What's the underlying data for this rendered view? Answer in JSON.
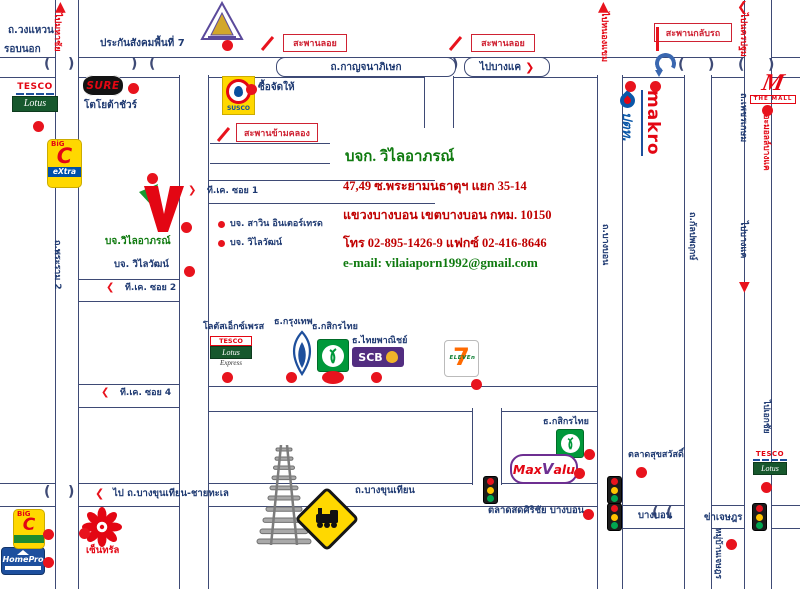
{
  "company": {
    "name": "บจก. วิไลอาภรณ์",
    "address_line1": "47,49 ซ.พระยามนธาตุฯ แยก 35-14",
    "address_line2": "แขวงบางบอน เขตบางบอน กทม. 10150",
    "phone_line": "โทร 02-895-1426-9 แฟกซ์ 02-416-8646",
    "email_line": "e-mail: vilaiaporn1992@gmail.com"
  },
  "colors": {
    "accent_red": "#e30613",
    "navy_text": "#1f3a72",
    "green_text": "#0f7a0f",
    "road_line": "#3e4a75"
  },
  "logos": {
    "tesco": "TESCO",
    "lotus": "Lotus",
    "express": "Express",
    "sure": "SURE",
    "bigc": "BiG",
    "bigc_c": "C",
    "bigc_extra": "eXtra",
    "susco": "SUSCO",
    "scb": "SCB",
    "seven": "7",
    "eleven": "ELEVEn",
    "maxvalu_pre": "Max",
    "maxvalu_v": "V",
    "maxvalu_post": "alu",
    "makro": "makro",
    "ptt": "ปตท.",
    "themall_m": "M",
    "themall": "THE MALL",
    "homepro": "HomePro"
  },
  "roads": [
    {
      "id": "kanchanaphisek-road",
      "o": "h",
      "x": 0,
      "y": 57,
      "w": 800,
      "h": 19
    },
    {
      "id": "tk-soi1-road",
      "o": "h",
      "x": 207,
      "y": 180,
      "w": 228,
      "h": 22
    },
    {
      "id": "tk-soi2-road",
      "o": "h",
      "x": 77,
      "y": 279,
      "w": 102,
      "h": 21
    },
    {
      "id": "tk-soi4-road",
      "o": "h",
      "x": 77,
      "y": 384,
      "w": 102,
      "h": 22
    },
    {
      "id": "mid-shops-road",
      "o": "h",
      "x": 207,
      "y": 386,
      "w": 390,
      "h": 24
    },
    {
      "id": "bangkhunthian-road",
      "o": "h",
      "x": 0,
      "y": 483,
      "w": 622,
      "h": 22
    },
    {
      "id": "ekkachai-east-road",
      "o": "h",
      "x": 622,
      "y": 505,
      "w": 178,
      "h": 22
    },
    {
      "id": "canal-road-horiz",
      "o": "h",
      "x": 210,
      "y": 143,
      "w": 120,
      "h": 19
    },
    {
      "id": "outer-ring-west-road",
      "o": "v",
      "x": 55,
      "y": 0,
      "w": 22,
      "h": 589
    },
    {
      "id": "tk-main-road",
      "o": "v",
      "x": 179,
      "y": 75,
      "w": 28,
      "h": 514
    },
    {
      "id": "canal-road-vert",
      "o": "v",
      "x": 424,
      "y": 76,
      "w": 28,
      "h": 52
    },
    {
      "id": "phraya-monthat-soi",
      "o": "v",
      "x": 472,
      "y": 408,
      "w": 28,
      "h": 77
    },
    {
      "id": "bangbon-vert-road",
      "o": "v",
      "x": 597,
      "y": 75,
      "w": 24,
      "h": 514
    },
    {
      "id": "kanlapaphruek-vert-road",
      "o": "v",
      "x": 684,
      "y": 75,
      "w": 26,
      "h": 514
    },
    {
      "id": "phetkasem-vert-road",
      "o": "v",
      "x": 744,
      "y": 0,
      "w": 26,
      "h": 589
    }
  ],
  "labels": [
    {
      "id": "ring-road-name-line1",
      "text": "ถ.วงแหวน",
      "x": 8,
      "y": 25
    },
    {
      "id": "ring-road-name-line2",
      "text": "รอบนอก",
      "x": 4,
      "y": 44
    },
    {
      "id": "to-mahachai",
      "text": "ไปมหาชัย",
      "x": 62,
      "y": 13,
      "rot": 1,
      "color": "red",
      "size": 9
    },
    {
      "id": "sso-office",
      "text": "ประกันสังคมพื้นที่ 7",
      "x": 100,
      "y": 38,
      "size": 10
    },
    {
      "id": "shop-sue-jad-hai",
      "text": "ซื้อจัดให้",
      "x": 258,
      "y": 82
    },
    {
      "id": "toyota-sure",
      "text": "โตโยต้าชัวร์",
      "x": 84,
      "y": 100
    },
    {
      "id": "tk-soi-1",
      "text": "ที.เค. ซอย 1",
      "x": 207,
      "y": 186,
      "size": 9
    },
    {
      "id": "co-savin-intertrade",
      "text": "บจ. สาวิน อินเตอร์เทรด",
      "x": 230,
      "y": 219,
      "size": 9
    },
    {
      "id": "co-vilaiwat-1",
      "text": "บจ. วิไลวัฒน์",
      "x": 230,
      "y": 238,
      "size": 9
    },
    {
      "id": "co-vilaiaporn",
      "text": "บจ.วิไลอาภรณ์",
      "x": 105,
      "y": 236,
      "color": "green",
      "size": 10
    },
    {
      "id": "co-vilaiwat-2",
      "text": "บจ. วิไลวัฒน์",
      "x": 114,
      "y": 260,
      "size": 9.5
    },
    {
      "id": "tk-soi-2",
      "text": "ที.เค. ซอย 2",
      "x": 125,
      "y": 283,
      "size": 9
    },
    {
      "id": "tk-soi-4",
      "text": "ที.เค. ซอย 4",
      "x": 120,
      "y": 388,
      "size": 9
    },
    {
      "id": "rama2-road",
      "text": "ถ.พระราม 2",
      "x": 62,
      "y": 240,
      "rot": 1,
      "size": 9
    },
    {
      "id": "lotus-express-label",
      "text": "โลตัสเอ็กซ์เพรส",
      "x": 203,
      "y": 322,
      "size": 9
    },
    {
      "id": "bank-bangkok",
      "text": "ธ.กรุงเทพ",
      "x": 274,
      "y": 317,
      "size": 9
    },
    {
      "id": "bank-kasikorn-1",
      "text": "ธ.กสิกรไทย",
      "x": 312,
      "y": 322,
      "size": 9
    },
    {
      "id": "bank-scb",
      "text": "ธ.ไทยพาณิชย์",
      "x": 352,
      "y": 336,
      "size": 9
    },
    {
      "id": "bank-kasikorn-2",
      "text": "ธ.กสิกรไทย",
      "x": 543,
      "y": 417,
      "size": 9
    },
    {
      "id": "market-suksawat",
      "text": "ตลาดสุขสวัสดิ์",
      "x": 628,
      "y": 450,
      "size": 9
    },
    {
      "id": "market-sirichai",
      "text": "ตลาดสดศิริชัย บางบอน",
      "x": 488,
      "y": 506,
      "size": 9.5
    },
    {
      "id": "road-seg-bangbon",
      "text": "บางบอน",
      "x": 638,
      "y": 511,
      "size": 9.5
    },
    {
      "id": "road-seg-chetsada",
      "text": "ข่าเจษฎร",
      "x": 704,
      "y": 513,
      "size": 9.5
    },
    {
      "id": "mooban-chetsada",
      "text": "หมู่บ้านเจษฎร",
      "x": 722,
      "y": 528,
      "rot": 1,
      "size": 8.5
    },
    {
      "id": "to-ekkachai",
      "text": "ไปเอกชัย",
      "x": 770,
      "y": 400,
      "rot": 1,
      "size": 8.5
    },
    {
      "id": "to-bangkhunthian-chaithale",
      "text": "ไป ถ.บางขุนเทียน-ชายทะเล",
      "x": 113,
      "y": 489,
      "size": 9.5
    },
    {
      "id": "bangkhunthian-label",
      "text": "ถ.บางขุนเทียน",
      "x": 355,
      "y": 486,
      "size": 9.5
    },
    {
      "id": "central-label",
      "text": "เซ็นทรัล",
      "x": 86,
      "y": 546,
      "color": "red",
      "size": 9.5
    },
    {
      "id": "to-nongkhaem",
      "text": "ไปหนองแขม",
      "x": 609,
      "y": 12,
      "rot": 1,
      "color": "red",
      "size": 9
    },
    {
      "id": "to-nakhonpathom",
      "text": "ไปนครปฐม",
      "x": 748,
      "y": 13,
      "rot": 1,
      "color": "red",
      "size": 9
    },
    {
      "id": "phetkasem-road",
      "text": "ถ.เพชรเกษม",
      "x": 748,
      "y": 93,
      "rot": 1,
      "size": 9
    },
    {
      "id": "the-mall-bangkhae",
      "text": "เดอะมอลล์บางแค",
      "x": 770,
      "y": 106,
      "rot": 1,
      "color": "red",
      "size": 8.5
    },
    {
      "id": "kanlapaphruek-road",
      "text": "ถ.กัลปพฤกษ์",
      "x": 697,
      "y": 212,
      "rot": 1,
      "size": 9
    },
    {
      "id": "to-bangkhae-south",
      "text": "ไปบางแค",
      "x": 748,
      "y": 221,
      "rot": 1,
      "size": 9
    },
    {
      "id": "bangbon-road",
      "text": "ถ.บางบอน",
      "x": 610,
      "y": 224,
      "rot": 1,
      "size": 9
    }
  ],
  "boxes": [
    {
      "id": "kanchanaphisek-box",
      "text": "ถ.กาญจนาภิเษก",
      "x": 276,
      "y": 57,
      "w": 178,
      "h": 18,
      "style": "road"
    },
    {
      "id": "to-bangkhae-box",
      "text": "ไปบางแค",
      "x": 464,
      "y": 57,
      "w": 84,
      "h": 18,
      "style": "road",
      "arrow": "❯"
    },
    {
      "id": "flyover-box-1",
      "text": "สะพานลอย",
      "x": 283,
      "y": 34,
      "w": 62,
      "h": 16,
      "style": "red"
    },
    {
      "id": "flyover-box-2",
      "text": "สะพานลอย",
      "x": 471,
      "y": 34,
      "w": 62,
      "h": 16,
      "style": "red"
    },
    {
      "id": "uturn-bridge-box",
      "text": "สะพานกลับรถ",
      "x": 654,
      "y": 23,
      "w": 76,
      "h": 17,
      "style": "red"
    },
    {
      "id": "canal-bridge-box",
      "text": "สะพานข้ามคลอง",
      "x": 236,
      "y": 123,
      "w": 80,
      "h": 17,
      "style": "red"
    }
  ],
  "dots": [
    {
      "id": "poi-sso",
      "x": 222,
      "y": 40
    },
    {
      "id": "poi-sure",
      "x": 128,
      "y": 83
    },
    {
      "id": "poi-lotus-west",
      "x": 33,
      "y": 121
    },
    {
      "id": "poi-vlogo-top",
      "x": 147,
      "y": 173
    },
    {
      "id": "poi-susco-shop",
      "x": 246,
      "y": 84
    },
    {
      "id": "poi-vilaiaporn",
      "x": 181,
      "y": 222
    },
    {
      "id": "poi-vilaiwat",
      "x": 184,
      "y": 266
    },
    {
      "id": "bullet-savin",
      "x": 218,
      "y": 221,
      "w": 7,
      "h": 7
    },
    {
      "id": "bullet-vilaiwat",
      "x": 218,
      "y": 240,
      "w": 7,
      "h": 7
    },
    {
      "id": "poi-lotus-express",
      "x": 222,
      "y": 372
    },
    {
      "id": "poi-bbl",
      "x": 286,
      "y": 372
    },
    {
      "id": "poi-kbank",
      "x": 322,
      "y": 371,
      "w": 22,
      "h": 13
    },
    {
      "id": "poi-scb",
      "x": 371,
      "y": 372
    },
    {
      "id": "poi-seven",
      "x": 471,
      "y": 379
    },
    {
      "id": "poi-kbank-2",
      "x": 584,
      "y": 449
    },
    {
      "id": "poi-suksawat",
      "x": 636,
      "y": 467
    },
    {
      "id": "poi-maxvalu",
      "x": 574,
      "y": 468
    },
    {
      "id": "poi-sirichai",
      "x": 583,
      "y": 509
    },
    {
      "id": "poi-lotus-bangbon",
      "x": 761,
      "y": 482
    },
    {
      "id": "poi-mooban",
      "x": 726,
      "y": 539
    },
    {
      "id": "poi-themall",
      "x": 762,
      "y": 105
    },
    {
      "id": "poi-makro-1",
      "x": 625,
      "y": 81
    },
    {
      "id": "poi-makro-2",
      "x": 650,
      "y": 81
    },
    {
      "id": "poi-central",
      "x": 79,
      "y": 528
    },
    {
      "id": "poi-bigc-south",
      "x": 43,
      "y": 529
    },
    {
      "id": "poi-homepro",
      "x": 43,
      "y": 557
    }
  ],
  "arrows": [
    {
      "id": "arrow-up-mahachai",
      "char": "▲",
      "x": 55,
      "y": 0,
      "size": 14
    },
    {
      "id": "arrow-up-nongkhaem",
      "char": "▲",
      "x": 598,
      "y": 0,
      "size": 14
    },
    {
      "id": "arrow-left-nakhonpathom",
      "char": "❮",
      "x": 737,
      "y": 1,
      "size": 13
    },
    {
      "id": "arrow-down-bangkhae",
      "char": "▼",
      "x": 739,
      "y": 280,
      "size": 14
    },
    {
      "id": "arrow-soi1",
      "char": "❯",
      "x": 188,
      "y": 186,
      "size": 10
    },
    {
      "id": "arrow-soi2",
      "char": "❮",
      "x": 106,
      "y": 283,
      "size": 10
    },
    {
      "id": "arrow-soi4",
      "char": "❮",
      "x": 101,
      "y": 388,
      "size": 10
    },
    {
      "id": "arrow-bangkhunthian",
      "char": "❮",
      "x": 95,
      "y": 488,
      "size": 11
    }
  ],
  "marks": [
    {
      "id": "flyover-slash-1",
      "x": 266,
      "y": 35,
      "w": 3,
      "h": 17,
      "rot": 40
    },
    {
      "id": "flyover-slash-2",
      "x": 454,
      "y": 35,
      "w": 3,
      "h": 17,
      "rot": 40
    },
    {
      "id": "canal-slash",
      "x": 222,
      "y": 126,
      "w": 3,
      "h": 17,
      "rot": 40
    },
    {
      "id": "uturn-pointer",
      "x": 656,
      "y": 27,
      "w": 2.5,
      "h": 24,
      "rot": 0
    }
  ],
  "arcs": [
    {
      "ch": "(",
      "x": 44,
      "y": 57
    },
    {
      "ch": ")",
      "x": 68,
      "y": 57
    },
    {
      "ch": ")",
      "x": 131,
      "y": 57
    },
    {
      "ch": "(",
      "x": 149,
      "y": 57
    },
    {
      "ch": "(",
      "x": 44,
      "y": 485
    },
    {
      "ch": ")",
      "x": 68,
      "y": 485
    },
    {
      "ch": "(",
      "x": 412,
      "y": 58
    },
    {
      "ch": ")",
      "x": 452,
      "y": 58
    },
    {
      "ch": "(",
      "x": 678,
      "y": 58
    },
    {
      "ch": ")",
      "x": 708,
      "y": 58
    },
    {
      "ch": "(",
      "x": 738,
      "y": 58
    },
    {
      "ch": ")",
      "x": 768,
      "y": 58
    },
    {
      "ch": "(",
      "x": 652,
      "y": 506
    },
    {
      "ch": "(",
      "x": 666,
      "y": 506
    }
  ],
  "traffic_lights": [
    {
      "x": 483,
      "y": 476
    },
    {
      "x": 607,
      "y": 476
    },
    {
      "x": 607,
      "y": 503
    },
    {
      "x": 752,
      "y": 503
    }
  ]
}
